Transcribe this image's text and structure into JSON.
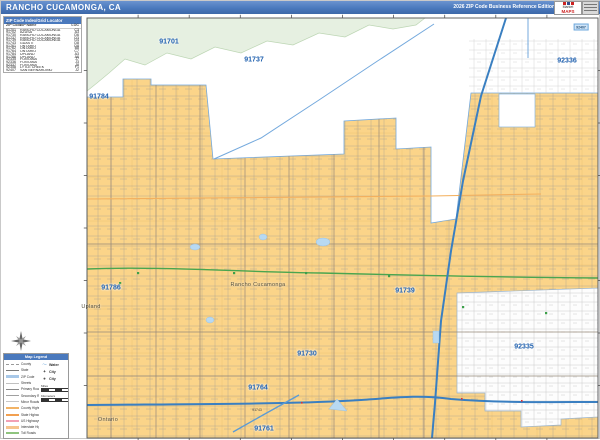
{
  "header": {
    "title": "RANCHO CUCAMONGA, CA",
    "edition": "2026 ZIP Code Business Reference Edition",
    "logo": {
      "brand_top": "Market",
      "brand": "MAPS"
    }
  },
  "index_table": {
    "title": "ZIP Code Index/Grid Locator",
    "columns": [
      "ZIP Code",
      "ZIP Name",
      "LOC"
    ],
    "rows": [
      [
        "91701",
        "RANCHO CUCAMONGA",
        "C3"
      ],
      [
        "91702",
        "AZUSA",
        "A3"
      ],
      [
        "91730",
        "RANCHO CUCAMONGA",
        "D6"
      ],
      [
        "91737",
        "RANCHO CUCAMONGA",
        "D3"
      ],
      [
        "91739",
        "RANCHO CUCAMONGA",
        "G4"
      ],
      [
        "91743",
        "GUASTI",
        "D8"
      ],
      [
        "91761",
        "ONTARIO",
        "D8"
      ],
      [
        "91762",
        "ONTARIO",
        "B8"
      ],
      [
        "91764",
        "ONTARIO",
        "C7"
      ],
      [
        "91784",
        "UPLAND",
        "A3"
      ],
      [
        "91786",
        "UPLAND",
        "A6"
      ],
      [
        "92335",
        "FONTANA",
        "J7"
      ],
      [
        "92336",
        "FONTANA",
        "J3"
      ],
      [
        "92337",
        "FONTANA",
        "J8"
      ],
      [
        "92358",
        "LYTLE CREEK",
        "F1"
      ],
      [
        "92407",
        "SAN BERNARDINO",
        "J2"
      ]
    ]
  },
  "map": {
    "zip_labels": [
      {
        "text": "91701",
        "x": 168,
        "y": 41
      },
      {
        "text": "91737",
        "x": 253,
        "y": 59
      },
      {
        "text": "92336",
        "x": 566,
        "y": 60
      },
      {
        "text": "91784",
        "x": 98,
        "y": 96
      },
      {
        "text": "91786",
        "x": 110,
        "y": 287
      },
      {
        "text": "91739",
        "x": 404,
        "y": 290
      },
      {
        "text": "91730",
        "x": 306,
        "y": 353
      },
      {
        "text": "92335",
        "x": 523,
        "y": 346
      },
      {
        "text": "91764",
        "x": 257,
        "y": 387
      },
      {
        "text": "91761",
        "x": 263,
        "y": 428
      }
    ],
    "city_labels": [
      {
        "text": "Rancho Cucamonga",
        "x": 257,
        "y": 284
      },
      {
        "text": "Upland",
        "x": 90,
        "y": 306
      },
      {
        "text": "Ontario",
        "x": 107,
        "y": 419
      }
    ],
    "small_labels": [
      {
        "text": "91743",
        "x": 256,
        "y": 409,
        "box": false
      },
      {
        "text": "92407",
        "x": 580,
        "y": 26,
        "box": true
      }
    ]
  },
  "legend": {
    "title": "Map Legend",
    "roads": [
      {
        "label": "County",
        "color": "#9a9a9a",
        "style": "dashed",
        "weight": 1
      },
      {
        "label": "State",
        "color": "#7a7a7a",
        "style": "solid",
        "weight": 1
      },
      {
        "label": "ZIP Code",
        "color": "#a8c8e8",
        "style": "solid",
        "weight": 3
      },
      {
        "label": "Streets",
        "color": "#c0c0c0",
        "style": "solid",
        "weight": 1
      },
      {
        "label": "Primary Roads",
        "color": "#8a8a8a",
        "style": "solid",
        "weight": 1
      },
      {
        "label": "Secondary Roads",
        "color": "#a0a0a0",
        "style": "solid",
        "weight": 1
      },
      {
        "label": "Minor Roads",
        "color": "#c8c8c8",
        "style": "solid",
        "weight": 1
      },
      {
        "label": "County Highways",
        "color": "#f2b366",
        "style": "solid",
        "weight": 2
      },
      {
        "label": "State Highways",
        "color": "#f2a050",
        "style": "solid",
        "weight": 2
      },
      {
        "label": "US Highways",
        "color": "#f2a0b4",
        "style": "solid",
        "weight": 2
      },
      {
        "label": "Interstate Highways",
        "color": "#f6c48e",
        "style": "solid",
        "weight": 3
      },
      {
        "label": "Toll Roads",
        "color": "#8fc47e",
        "style": "solid",
        "weight": 2
      }
    ],
    "symbols": [
      {
        "icon": "water",
        "label": "Water"
      },
      {
        "icon": "star",
        "label": "City"
      },
      {
        "icon": "circle",
        "label": "City"
      }
    ],
    "scale_labels": [
      "Miles",
      "Kilometers"
    ]
  },
  "colors": {
    "header_bar": "#4a79bd",
    "highlight_yellow": "#fbd489",
    "forest_green": "#e6f0e1",
    "zip_label_blue": "#1e5fae",
    "boundary_blue": "#74a9dd",
    "freeway_blue": "#3a7fc1",
    "route_green": "#4aa54f",
    "water_blue": "#b8d9f2"
  }
}
